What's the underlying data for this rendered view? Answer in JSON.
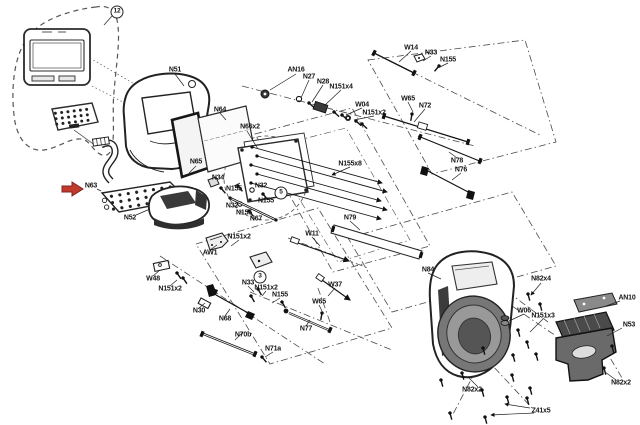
{
  "canvas": {
    "width": 640,
    "height": 425,
    "background": "#ffffff"
  },
  "colors": {
    "line": "#2b2b2b",
    "construction_line": "#4a4a4a",
    "dark_fill": "#3c3c3c",
    "mid_fill": "#777777",
    "accent_arrow": "#c0392b"
  },
  "figure": {
    "type": "exploded-parts-diagram",
    "callout_arrow": {
      "icon": "red-arrow-icon",
      "points_to": "N63"
    },
    "labels": [
      {
        "text": "12",
        "x": 117,
        "y": 12,
        "circled": true
      },
      {
        "text": "N51",
        "x": 175,
        "y": 70
      },
      {
        "text": "N64",
        "x": 220,
        "y": 110
      },
      {
        "text": "N66x2",
        "x": 250,
        "y": 127
      },
      {
        "text": "N65",
        "x": 196,
        "y": 162
      },
      {
        "text": "N63",
        "x": 91,
        "y": 186
      },
      {
        "text": "N52",
        "x": 130,
        "y": 218
      },
      {
        "text": "N34",
        "x": 218,
        "y": 178
      },
      {
        "text": "N155",
        "x": 234,
        "y": 189
      },
      {
        "text": "N32",
        "x": 261,
        "y": 186
      },
      {
        "text": "5",
        "x": 281,
        "y": 193,
        "circled": true
      },
      {
        "text": "N155",
        "x": 266,
        "y": 201
      },
      {
        "text": "N32",
        "x": 232,
        "y": 206
      },
      {
        "text": "N155",
        "x": 244,
        "y": 213
      },
      {
        "text": "N67",
        "x": 256,
        "y": 219
      },
      {
        "text": "N155x8",
        "x": 350,
        "y": 164
      },
      {
        "text": "AN16",
        "x": 296,
        "y": 70
      },
      {
        "text": "N27",
        "x": 309,
        "y": 77
      },
      {
        "text": "N28",
        "x": 323,
        "y": 82
      },
      {
        "text": "N151x4",
        "x": 341,
        "y": 87
      },
      {
        "text": "W04",
        "x": 362,
        "y": 105
      },
      {
        "text": "N151x2",
        "x": 374,
        "y": 113
      },
      {
        "text": "W14",
        "x": 411,
        "y": 48
      },
      {
        "text": "N33",
        "x": 431,
        "y": 53
      },
      {
        "text": "N155",
        "x": 448,
        "y": 60
      },
      {
        "text": "W65",
        "x": 408,
        "y": 99
      },
      {
        "text": "N72",
        "x": 425,
        "y": 106
      },
      {
        "text": "N78",
        "x": 457,
        "y": 161
      },
      {
        "text": "N76",
        "x": 461,
        "y": 170
      },
      {
        "text": "N79",
        "x": 350,
        "y": 218
      },
      {
        "text": "W11",
        "x": 312,
        "y": 234
      },
      {
        "text": "W37",
        "x": 335,
        "y": 285
      },
      {
        "text": "N151x2",
        "x": 239,
        "y": 237
      },
      {
        "text": "AW1",
        "x": 210,
        "y": 253
      },
      {
        "text": "W48",
        "x": 153,
        "y": 279
      },
      {
        "text": "N151x2",
        "x": 170,
        "y": 289
      },
      {
        "text": "N30",
        "x": 199,
        "y": 311
      },
      {
        "text": "N33",
        "x": 248,
        "y": 283
      },
      {
        "text": "3",
        "x": 260,
        "y": 277,
        "circled": true
      },
      {
        "text": "N151x2",
        "x": 266,
        "y": 288
      },
      {
        "text": "N155",
        "x": 280,
        "y": 295
      },
      {
        "text": "W65",
        "x": 319,
        "y": 302
      },
      {
        "text": "N68",
        "x": 225,
        "y": 319
      },
      {
        "text": "N70b",
        "x": 243,
        "y": 335
      },
      {
        "text": "N71a",
        "x": 273,
        "y": 349
      },
      {
        "text": "N77",
        "x": 306,
        "y": 329
      },
      {
        "text": "N84",
        "x": 428,
        "y": 270
      },
      {
        "text": "N82x4",
        "x": 541,
        "y": 279
      },
      {
        "text": "W06",
        "x": 524,
        "y": 311
      },
      {
        "text": "N151x3",
        "x": 543,
        "y": 316
      },
      {
        "text": "AN10",
        "x": 627,
        "y": 298
      },
      {
        "text": "N53",
        "x": 629,
        "y": 325
      },
      {
        "text": "N82x2",
        "x": 621,
        "y": 383
      },
      {
        "text": "N82x2",
        "x": 472,
        "y": 390
      },
      {
        "text": "Z41x5",
        "x": 541,
        "y": 411
      }
    ]
  }
}
